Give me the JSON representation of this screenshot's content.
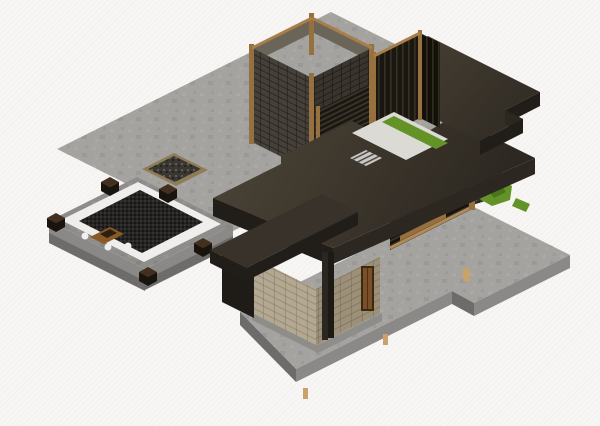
{
  "viewport": {
    "type": "isometric-3d-render",
    "width": 600,
    "height": 426,
    "view_label": "3D axonometric view"
  },
  "scene": {
    "description": "Isometric 3D render of a modern flat-roof house model with concrete terraces, a spa patio deck, a stone-clad tower, slatted courtyard walls, timber posts and landscaping",
    "elements": [
      "concrete-terrace",
      "gravel-inset",
      "spa-patio",
      "patio-bench-band",
      "patio-deck",
      "patio-planters",
      "decor-tray",
      "pebble-dots",
      "concrete-walkway",
      "entry-volume",
      "entry-door",
      "steel-pillar",
      "main-roof",
      "entry-canopy-roof",
      "right-wing-roof",
      "stone-tower",
      "tower-corner-posts",
      "courtyard-slat-walls",
      "courtyard-floor",
      "grass-strips",
      "gravel-bed",
      "shrubs",
      "louver-screen",
      "floor-grate",
      "decor-bottles"
    ]
  },
  "colors": {
    "background": "#f7f6f4",
    "concrete": "#a4a3a0",
    "concrete_dark": "#8e8d8a",
    "concrete_side": "#8a8987",
    "concrete_side2": "#6d6c6a",
    "patio_white": "#efeeec",
    "deck": "#262422",
    "planter": "#432f1e",
    "planter_dark": "#1a140e",
    "tray": "#8a5a26",
    "tray_item": "#2a1f12",
    "roof_fascia": "#211d18",
    "roof_fascia2": "#2c2720",
    "roof_wing": "#38322a",
    "beige": "#b3a892",
    "beige_dark": "#9c9079",
    "wood": "#96713f",
    "wood_light": "#b28a55",
    "stone_inner": "#6a6459",
    "stone_sw": "#45403a",
    "stone_se": "#39342e",
    "slat": "#1a1712",
    "slat2": "#121009",
    "court_floor": "#dcdad4",
    "grass": "#639227",
    "grass_dark": "#49761c",
    "gravel": "#34312c",
    "louver": "#16130f",
    "pillar": "#2a2620",
    "pillar_dark": "#1d1a15",
    "door": "#7a5126",
    "shadow_wall": "#1f1b16",
    "pebble": "#3a3733",
    "pebble_border": "#8f7d58",
    "bottle": "#c9a26b",
    "white_dot": "#f1f0ee",
    "grate": "#c9c8c4"
  }
}
